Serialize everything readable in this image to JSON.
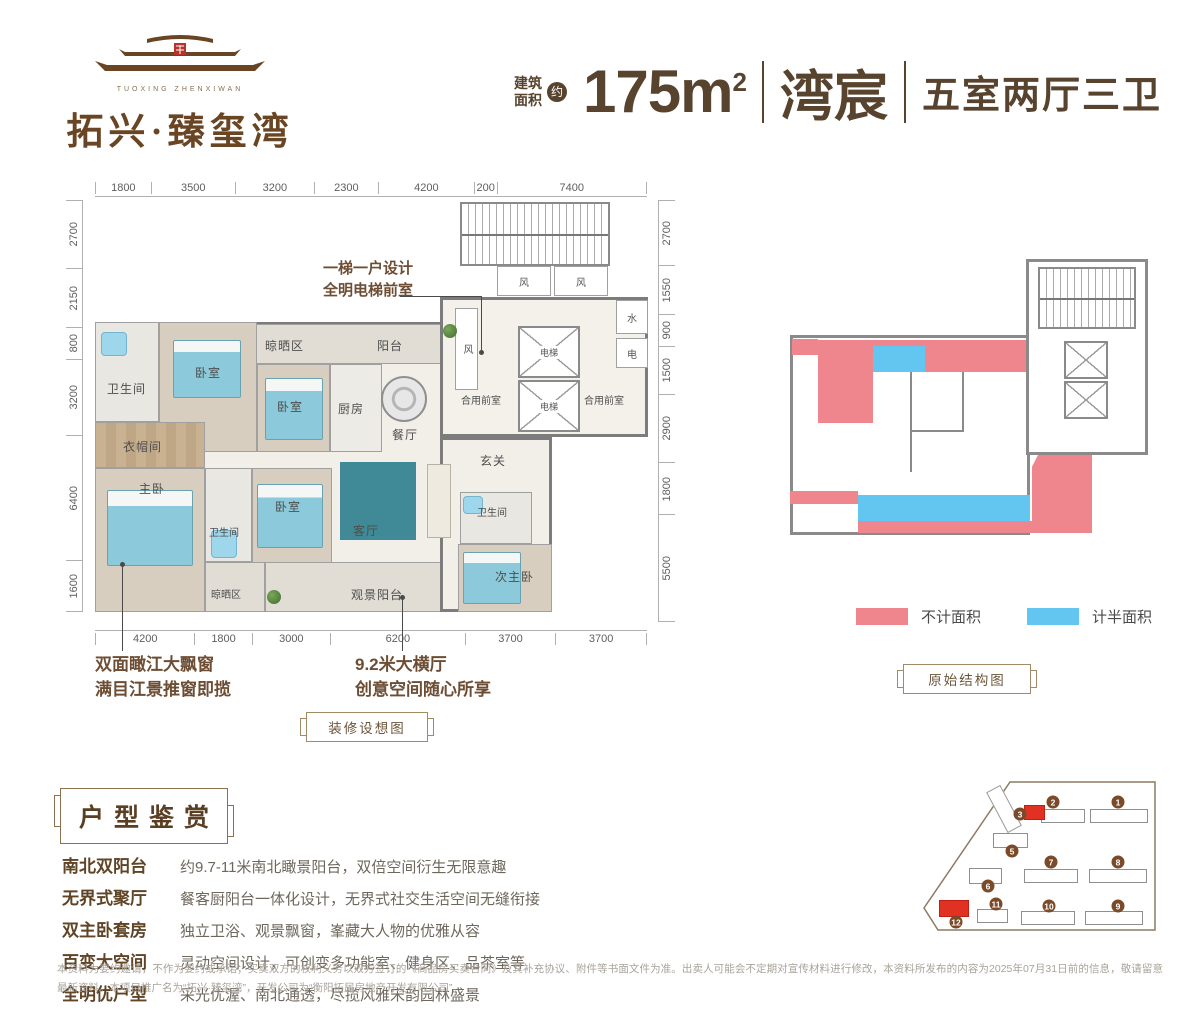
{
  "colors": {
    "brand_brown": "#57432e",
    "logo_brown": "#6a4524",
    "legend_red": "#ef858d",
    "legend_blue": "#63c6f0",
    "site_red": "#e03122"
  },
  "logo": {
    "latin": "TUOXING ZHENXIWAN",
    "name": "拓兴·臻玺湾"
  },
  "header": {
    "area_label_l1": "建筑",
    "area_label_l2": "面积",
    "approx": "约",
    "area_value": "175m",
    "area_sup": "2",
    "unit_name": "湾宸",
    "rooms_desc": "五室两厅三卫"
  },
  "floorplan": {
    "dims_top": [
      "1800",
      "3500",
      "3200",
      "2300",
      "4200",
      "200",
      "7400"
    ],
    "dims_bottom": [
      "4200",
      "1800",
      "3000",
      "6200",
      "3700",
      "3700"
    ],
    "dims_left": [
      "2700",
      "2150",
      "800",
      "3200",
      "6400",
      "1600"
    ],
    "dims_right": [
      "2700",
      "1550",
      "900",
      "1500",
      "2900",
      "1800",
      "5500"
    ],
    "rooms": {
      "bathroom": "卫生间",
      "bedroom": "卧室",
      "drying": "晾晒区",
      "balcony": "阳台",
      "kitchen": "厨房",
      "dining": "餐厅",
      "cloakroom": "衣帽间",
      "master": "主卧",
      "living": "客厅",
      "foyer": "玄关",
      "second_master": "次主卧",
      "view_balcony": "观景阳台",
      "wind": "风",
      "elevator": "电梯",
      "water": "水",
      "electric": "电",
      "shared_lobby": "合用前室"
    },
    "callouts": {
      "elevator_l1": "一梯一户设计",
      "elevator_l2": "全明电梯前室",
      "bay_l1": "双面瞰江大飘窗",
      "bay_l2": "满目江景推窗即揽",
      "hall_l1": "9.2米大横厅",
      "hall_l2": "创意空间随心所享"
    },
    "plaque": "装修设想图"
  },
  "structural": {
    "plaque": "原始结构图",
    "legend": [
      {
        "label": "不计面积",
        "color": "#ef858d"
      },
      {
        "label": "计半面积",
        "color": "#63c6f0"
      }
    ]
  },
  "features": {
    "title": "户型鉴赏",
    "items": [
      {
        "label": "南北双阳台",
        "desc": "约9.7-11米南北瞰景阳台，双倍空间衍生无限意趣"
      },
      {
        "label": "无界式聚厅",
        "desc": "餐客厨阳台一体化设计，无界式社交生活空间无缝衔接"
      },
      {
        "label": "双主卧套房",
        "desc": "独立卫浴、观景飘窗，峯藏大人物的优雅从容"
      },
      {
        "label": "百变大空间",
        "desc": "灵动空间设计，可创变多功能室、健身区、品茶室等"
      },
      {
        "label": "全明优户型",
        "desc": "采光优渥、南北通透，尽揽风雅宋韵园林盛景"
      }
    ]
  },
  "siteplan": {
    "buildings": [
      {
        "num": "1",
        "bx": 178,
        "by": 37,
        "bw": 58,
        "bh": 14,
        "cx": 206,
        "cy": 30,
        "red": false
      },
      {
        "num": "2",
        "bx": 129,
        "by": 37,
        "bw": 44,
        "bh": 14,
        "cx": 141,
        "cy": 30,
        "red": false
      },
      {
        "num": "3",
        "bx": 112,
        "by": 33,
        "bw": 21,
        "bh": 15,
        "cx": 108,
        "cy": 42,
        "red": true
      },
      {
        "num": "5",
        "bx": 81,
        "by": 61,
        "bw": 35,
        "bh": 15,
        "cx": 100,
        "cy": 79,
        "red": false
      },
      {
        "num": "6",
        "bx": 57,
        "by": 96,
        "bw": 33,
        "bh": 16,
        "cx": 76,
        "cy": 114,
        "red": false
      },
      {
        "num": "7",
        "bx": 112,
        "by": 97,
        "bw": 54,
        "bh": 14,
        "cx": 139,
        "cy": 90,
        "red": false
      },
      {
        "num": "8",
        "bx": 177,
        "by": 97,
        "bw": 58,
        "bh": 14,
        "cx": 206,
        "cy": 90,
        "red": false
      },
      {
        "num": "9",
        "bx": 173,
        "by": 139,
        "bw": 58,
        "bh": 14,
        "cx": 206,
        "cy": 134,
        "red": false
      },
      {
        "num": "10",
        "bx": 109,
        "by": 139,
        "bw": 54,
        "bh": 14,
        "cx": 137,
        "cy": 134,
        "red": false
      },
      {
        "num": "11",
        "bx": 65,
        "by": 137,
        "bw": 31,
        "bh": 14,
        "cx": 84,
        "cy": 132,
        "red": false
      },
      {
        "num": "12",
        "bx": 27,
        "by": 128,
        "bw": 30,
        "bh": 17,
        "cx": 44,
        "cy": 150,
        "red": true
      }
    ]
  },
  "disclaimer": "本资料为要约邀请，不作为要约或承诺；买卖双方的权利义务以双方签订的《商品房买卖合同》及其补充协议、附件等书面文件为准。出卖人可能会不定期对宣传材料进行修改，本资料所发布的内容为2025年07月31日前的信息，敬请留意最新资料。本项目推广名为“拓兴·臻玺湾”，开发公司为“衡阳拓居房地产开发有限公司”。"
}
